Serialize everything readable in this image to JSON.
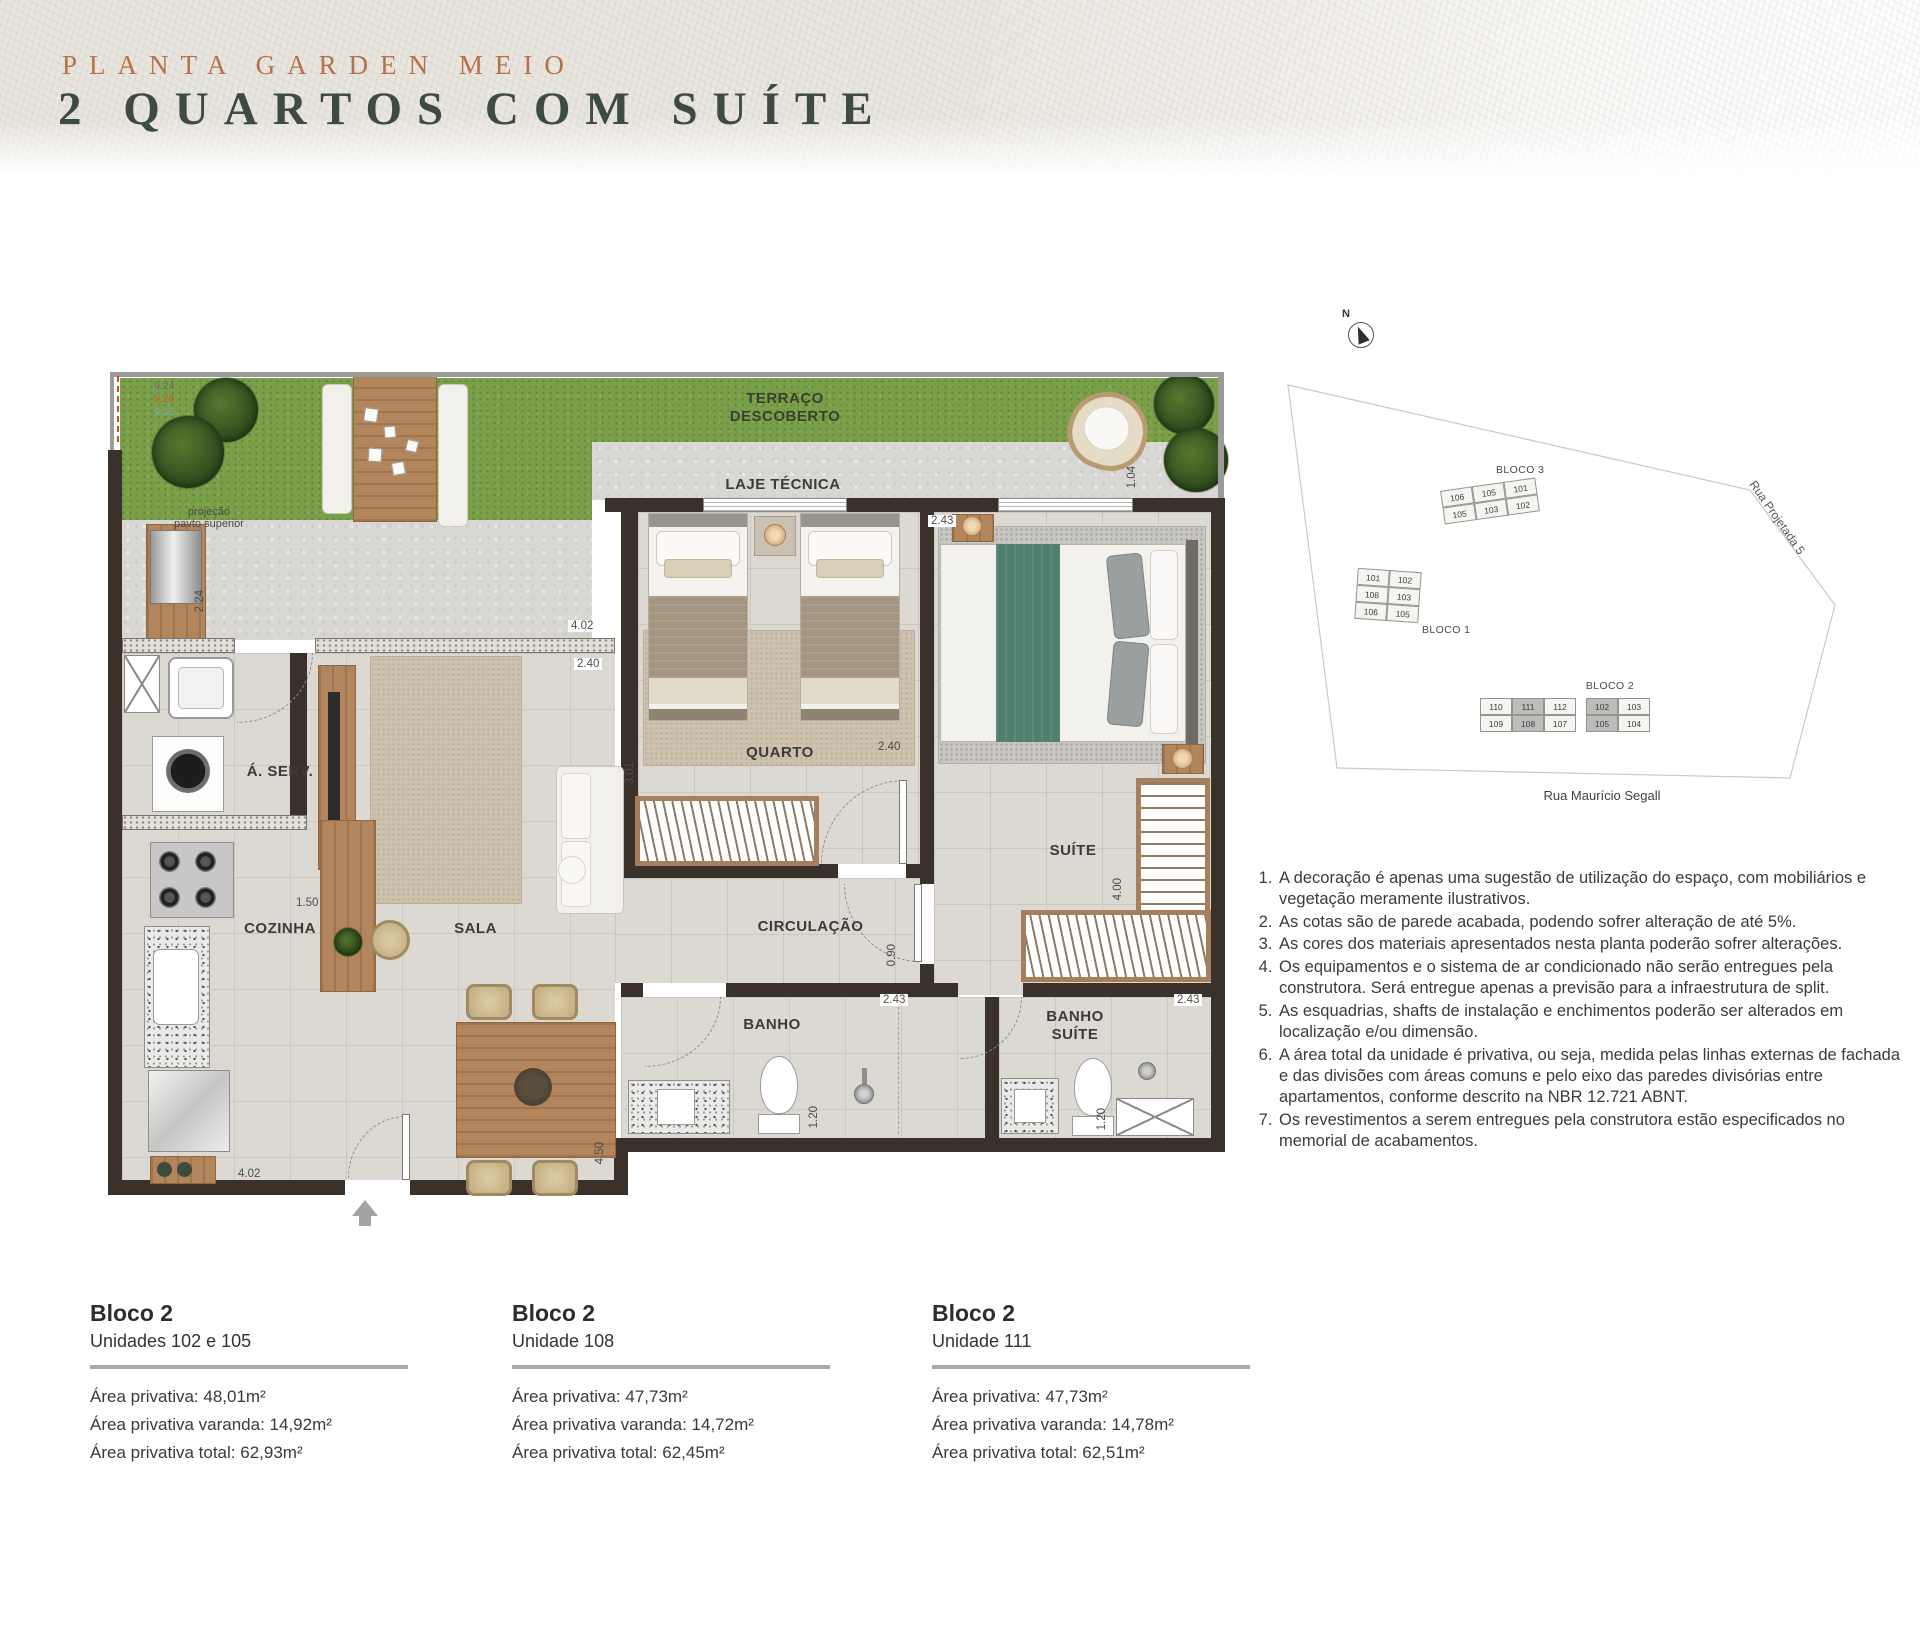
{
  "header": {
    "kicker": "PLANTA GARDEN MEIO",
    "title": "2 QUARTOS COM SUÍTE"
  },
  "plan": {
    "rooms": {
      "terraco": "TERRAÇO\nDESCOBERTO",
      "laje": "LAJE TÉCNICA",
      "quarto": "QUARTO",
      "suite": "SUÍTE",
      "circulacao": "CIRCULAÇÃO",
      "banho": "BANHO",
      "banho_suite": "BANHO\nSUÍTE",
      "sala": "SALA",
      "cozinha": "COZINHA",
      "aserv": "Á. SERV."
    },
    "annotations": {
      "projecao": "projeção\npavto superior",
      "levels": [
        "9.24",
        "9.20",
        "9.15"
      ]
    },
    "dims": {
      "terraco_left": "2.24",
      "terraco_right": "1.04",
      "sala_top": "4.02",
      "sala_top2": "2.40",
      "quarto_w": "2.40",
      "quarto_h": "3.01",
      "suite_w": "2.43",
      "suite_h": "4.00",
      "circ": "0.90",
      "banho_w": "2.43",
      "banho_h": "1.20",
      "bsuite_w": "2.43",
      "bsuite_h": "1.20",
      "cozinha": "1.50",
      "cozinha_bottom": "4.02",
      "sala_right": "4.50"
    }
  },
  "site_map": {
    "north": "N",
    "streets": {
      "bottom": "Rua Maurício Segall",
      "right": "Rua Projetada 5"
    },
    "blocks": [
      {
        "name": "BLOCO 3",
        "rows": [
          [
            "106",
            "105",
            "101"
          ],
          [
            "105",
            "103",
            "102"
          ]
        ]
      },
      {
        "name": "BLOCO 1",
        "rows": [
          [
            "101",
            "102"
          ],
          [
            "108",
            "103"
          ],
          [
            "106",
            "105"
          ]
        ]
      },
      {
        "name": "BLOCO 2",
        "rows": [
          [
            "110",
            "111",
            "112",
            "102",
            "103"
          ],
          [
            "109",
            "108",
            "107",
            "105",
            "104"
          ]
        ],
        "highlighted": [
          "111",
          "108",
          "102",
          "105"
        ]
      }
    ]
  },
  "notes": [
    "A decoração é apenas uma sugestão de utilização do espaço, com mobiliários e vegetação meramente ilustrativos.",
    "As cotas são de parede acabada, podendo sofrer alteração de até 5%.",
    "As cores dos materiais apresentados nesta planta poderão sofrer alterações.",
    "Os equipamentos e o sistema de ar condicionado não serão entregues pela construtora. Será entregue apenas a previsão para a infraestrutura de split.",
    "As esquadrias, shafts de instalação e enchimentos poderão ser alterados em localização e/ou dimensão.",
    "A área total da unidade é privativa, ou seja, medida pelas linhas externas de fachada e das divisões com áreas comuns e pelo eixo das paredes divisórias entre apartamentos, conforme descrito na NBR 12.721 ABNT.",
    "Os revestimentos a serem entregues pela construtora estão especificados no memorial de acabamentos."
  ],
  "units": [
    {
      "block": "Bloco 2",
      "unit": "Unidades 102 e 105",
      "privativa": "Área privativa: 48,01m²",
      "varanda": "Área privativa varanda: 14,92m²",
      "total": "Área privativa total: 62,93m²"
    },
    {
      "block": "Bloco 2",
      "unit": "Unidade 108",
      "privativa": "Área privativa: 47,73m²",
      "varanda": "Área privativa varanda: 14,72m²",
      "total": "Área privativa total: 62,45m²"
    },
    {
      "block": "Bloco 2",
      "unit": "Unidade 111",
      "privativa": "Área privativa: 47,73m²",
      "varanda": "Área privativa varanda: 14,78m²",
      "total": "Área privativa total: 62,51m²"
    }
  ],
  "colors": {
    "accent_kicker": "#b5714b",
    "title_green": "#3e4b43",
    "wall": "#3a312b",
    "grass": "#79a048",
    "suite_green": "#507e6f",
    "level_mid": "#c85a2d",
    "level_low": "#8aa4a8",
    "highlight_cell": "#bcbcba"
  }
}
